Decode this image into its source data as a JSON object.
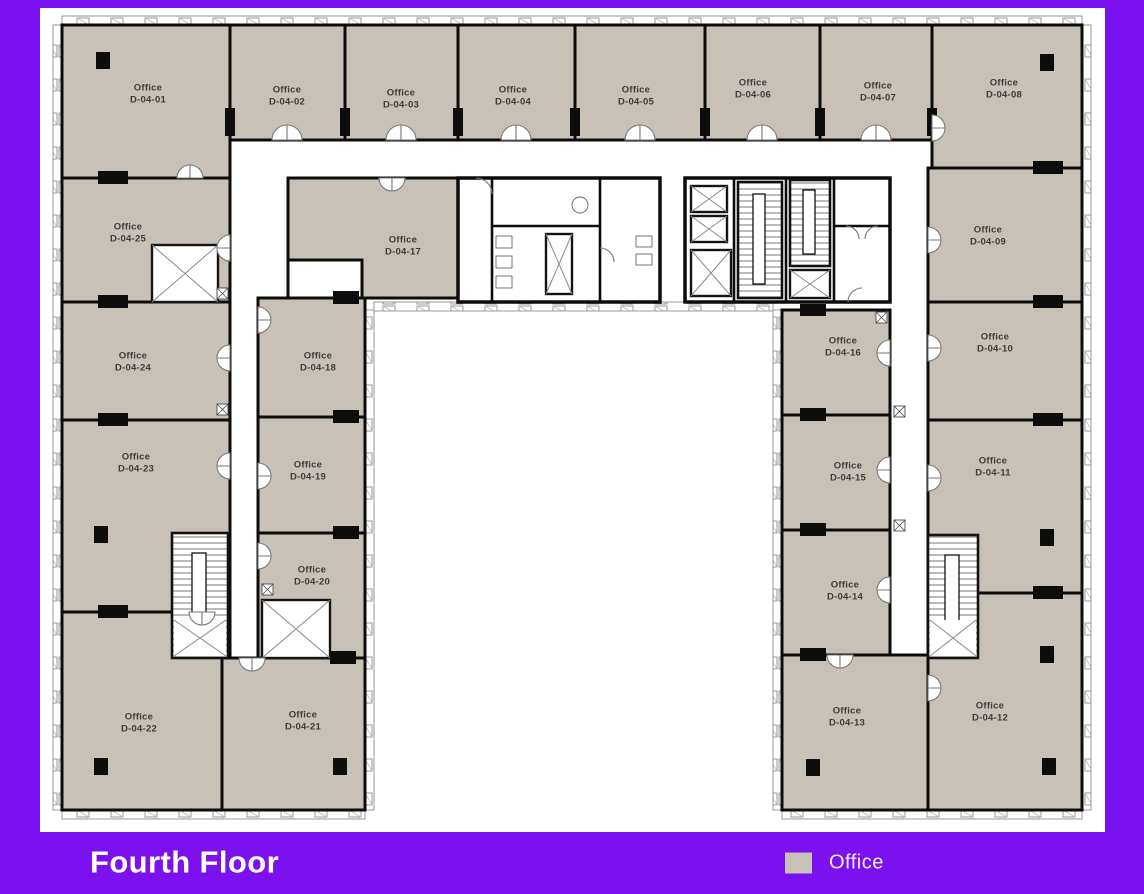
{
  "colors": {
    "frame": "#7c11f0",
    "canvas": "#ffffff",
    "room_fill": "#c8c1b7",
    "wall": "#0c0c0c",
    "label_text": "#3c3c3c"
  },
  "footer": {
    "title": "Fourth Floor",
    "legend": [
      {
        "label": "Office",
        "swatch_color": "#c8c1b7"
      }
    ]
  },
  "rooms": {
    "r01": {
      "type": "Office",
      "id": "D-04-01"
    },
    "r02": {
      "type": "Office",
      "id": "D-04-02"
    },
    "r03": {
      "type": "Office",
      "id": "D-04-03"
    },
    "r04": {
      "type": "Office",
      "id": "D-04-04"
    },
    "r05": {
      "type": "Office",
      "id": "D-04-05"
    },
    "r06": {
      "type": "Office",
      "id": "D-04-06"
    },
    "r07": {
      "type": "Office",
      "id": "D-04-07"
    },
    "r08": {
      "type": "Office",
      "id": "D-04-08"
    },
    "r09": {
      "type": "Office",
      "id": "D-04-09"
    },
    "r10": {
      "type": "Office",
      "id": "D-04-10"
    },
    "r11": {
      "type": "Office",
      "id": "D-04-11"
    },
    "r12": {
      "type": "Office",
      "id": "D-04-12"
    },
    "r13": {
      "type": "Office",
      "id": "D-04-13"
    },
    "r14": {
      "type": "Office",
      "id": "D-04-14"
    },
    "r15": {
      "type": "Office",
      "id": "D-04-15"
    },
    "r16": {
      "type": "Office",
      "id": "D-04-16"
    },
    "r17": {
      "type": "Office",
      "id": "D-04-17"
    },
    "r18": {
      "type": "Office",
      "id": "D-04-18"
    },
    "r19": {
      "type": "Office",
      "id": "D-04-19"
    },
    "r20": {
      "type": "Office",
      "id": "D-04-20"
    },
    "r21": {
      "type": "Office",
      "id": "D-04-21"
    },
    "r22": {
      "type": "Office",
      "id": "D-04-22"
    },
    "r23": {
      "type": "Office",
      "id": "D-04-23"
    },
    "r24": {
      "type": "Office",
      "id": "D-04-24"
    },
    "r25": {
      "type": "Office",
      "id": "D-04-25"
    }
  }
}
